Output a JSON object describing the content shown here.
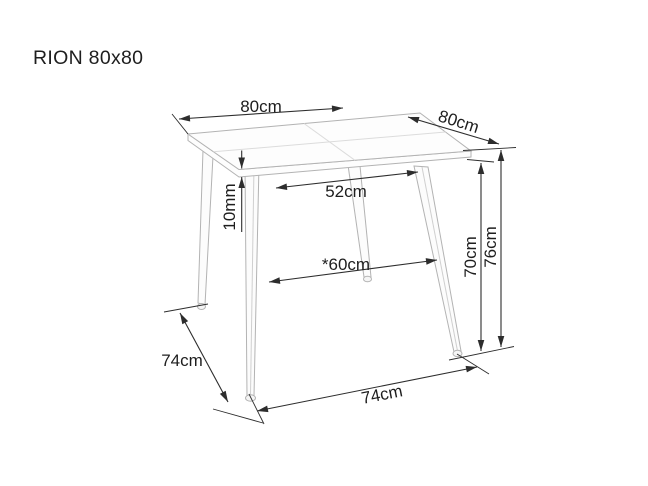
{
  "title": "RION 80x80",
  "labels": {
    "top_width": "80cm",
    "top_depth": "80cm",
    "top_thickness": "10mm",
    "inner_width_upper": "52cm",
    "inner_width_lower": "*60cm",
    "clearance_height": "70cm",
    "total_height": "76cm",
    "base_depth": "74cm",
    "base_width": "74cm"
  },
  "colors": {
    "background": "#ffffff",
    "furniture_line": "#b3b3b3",
    "seam_line": "#dcdcdc",
    "dimension_line": "#2d2d2d",
    "text": "#1e1e1e"
  }
}
